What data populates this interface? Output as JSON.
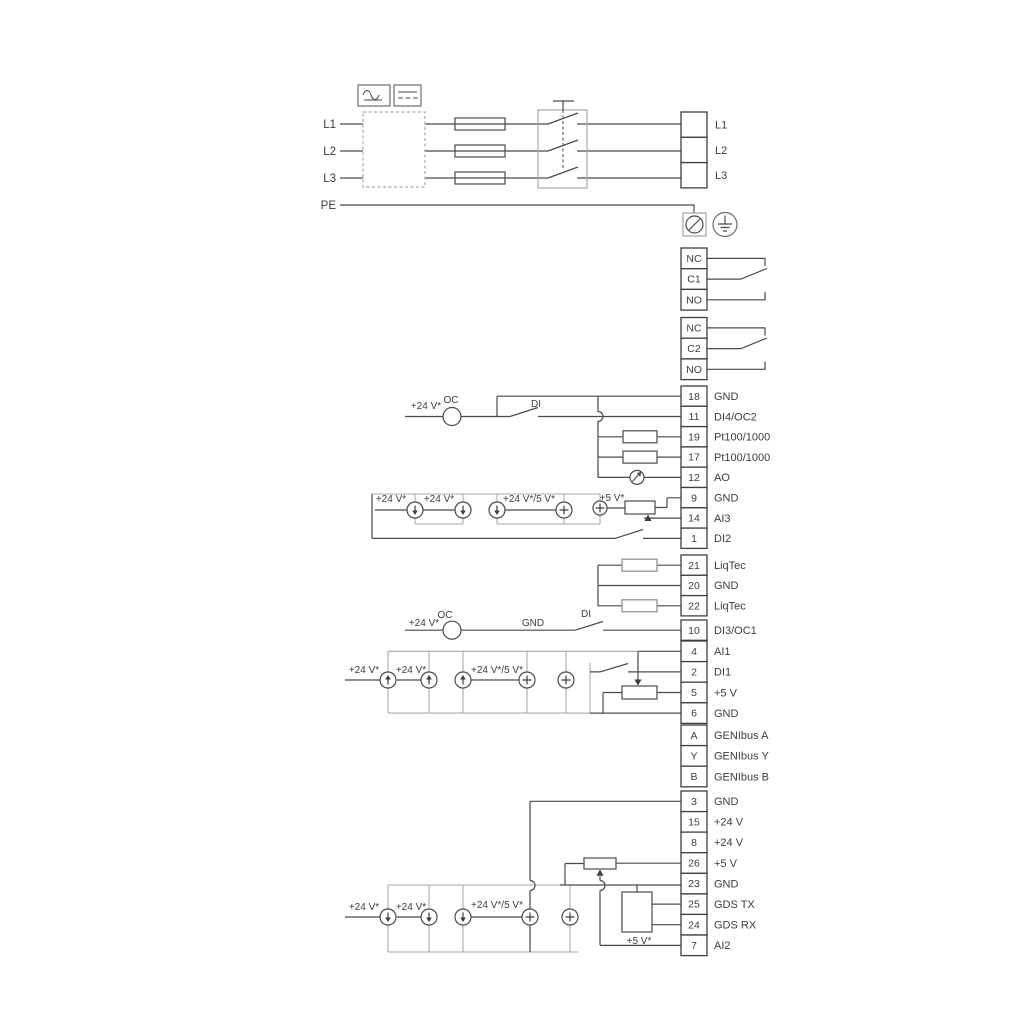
{
  "power_section": {
    "input_labels": [
      "L1",
      "L2",
      "L3",
      "PE"
    ],
    "output_terminals": [
      "L1",
      "L2",
      "L3"
    ],
    "symbols": [
      "ac-wave-icon",
      "dc-line-icon",
      "supply-filter-box",
      "fuse",
      "contactor-switch",
      "cable-gland-icon",
      "earth-ground-icon"
    ]
  },
  "relay_blocks": [
    {
      "terminals": [
        "NC",
        "C1",
        "NO"
      ]
    },
    {
      "terminals": [
        "NC",
        "C2",
        "NO"
      ]
    }
  ],
  "terminal_blocks": [
    {
      "id": "io1",
      "terminals": [
        {
          "num": "18",
          "label": "GND"
        },
        {
          "num": "11",
          "label": "DI4/OC2"
        },
        {
          "num": "19",
          "label": "Pt100/1000"
        },
        {
          "num": "17",
          "label": "Pt100/1000"
        },
        {
          "num": "12",
          "label": "AO"
        },
        {
          "num": "9",
          "label": "GND"
        },
        {
          "num": "14",
          "label": "AI3"
        },
        {
          "num": "1",
          "label": "DI2"
        }
      ]
    },
    {
      "id": "liqtec",
      "terminals": [
        {
          "num": "21",
          "label": "LiqTec"
        },
        {
          "num": "20",
          "label": "GND"
        },
        {
          "num": "22",
          "label": "LiqTec"
        }
      ]
    },
    {
      "id": "di3",
      "terminals": [
        {
          "num": "10",
          "label": "DI3/OC1"
        }
      ]
    },
    {
      "id": "io2",
      "terminals": [
        {
          "num": "4",
          "label": "AI1"
        },
        {
          "num": "2",
          "label": "DI1"
        },
        {
          "num": "5",
          "label": "+5 V"
        },
        {
          "num": "6",
          "label": "GND"
        }
      ]
    },
    {
      "id": "genibus",
      "terminals": [
        {
          "num": "A",
          "label": "GENIbus A"
        },
        {
          "num": "Y",
          "label": "GENIbus Y"
        },
        {
          "num": "B",
          "label": "GENIbus B"
        }
      ]
    },
    {
      "id": "io3",
      "terminals": [
        {
          "num": "3",
          "label": "GND"
        },
        {
          "num": "15",
          "label": "+24 V"
        },
        {
          "num": "8",
          "label": "+24 V"
        },
        {
          "num": "26",
          "label": "+5 V"
        },
        {
          "num": "23",
          "label": "GND"
        },
        {
          "num": "25",
          "label": "GDS TX"
        },
        {
          "num": "24",
          "label": "GDS RX"
        },
        {
          "num": "7",
          "label": "AI2"
        }
      ]
    }
  ],
  "annotations": [
    {
      "id": "p24_di4",
      "text": "+24 V*"
    },
    {
      "id": "oc_top",
      "text": "OC"
    },
    {
      "id": "di_top",
      "text": "DI"
    },
    {
      "id": "ai3_p24a",
      "text": "+24 V*"
    },
    {
      "id": "ai3_p24b",
      "text": "+24 V*"
    },
    {
      "id": "ai3_p245",
      "text": "+24 V*/5 V*"
    },
    {
      "id": "ai3_p5",
      "text": "+5 V*"
    },
    {
      "id": "di3_p24",
      "text": "+24 V*"
    },
    {
      "id": "di3_oc",
      "text": "OC"
    },
    {
      "id": "di3_gnd",
      "text": "GND"
    },
    {
      "id": "di3_di",
      "text": "DI"
    },
    {
      "id": "ai1_p24a",
      "text": "+24 V*"
    },
    {
      "id": "ai1_p24b",
      "text": "+24 V*"
    },
    {
      "id": "ai1_p245",
      "text": "+24 V*/5 V*"
    },
    {
      "id": "ai2_p24a",
      "text": "+24 V*"
    },
    {
      "id": "ai2_p24b",
      "text": "+24 V*"
    },
    {
      "id": "ai2_p245",
      "text": "+24 V*/5 V*"
    },
    {
      "id": "ai2_p5",
      "text": "+5 V*"
    }
  ],
  "colors": {
    "wire": "#4a4a4a",
    "bracket": "#a9a9a9",
    "text": "#3d3d3d",
    "background": "#ffffff"
  }
}
